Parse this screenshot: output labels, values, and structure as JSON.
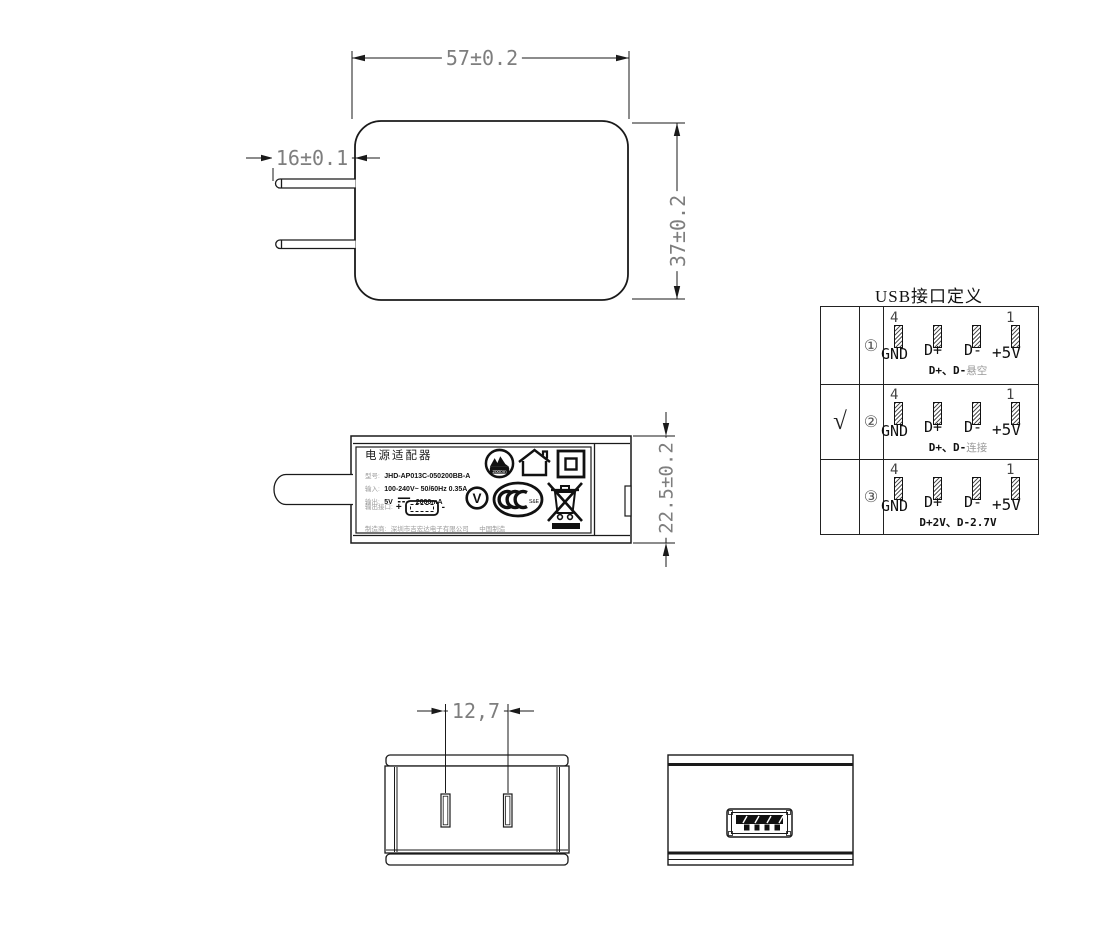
{
  "dimensions": {
    "front_width": "57±0.2",
    "prong_length": "16±0.1",
    "front_height": "37±0.2",
    "side_thickness": "22.5±0.2",
    "prong_pitch": "12,7"
  },
  "label": {
    "title": "电源适配器",
    "model_key": "型号:",
    "model_value": "JHD-AP013C-050200BB-A",
    "input_key": "输入:",
    "input_value": "100-240V~  50/60Hz  0.35A",
    "output_key": "输出:",
    "output_voltage": "5V",
    "output_current": "2000mA",
    "port_key": "输出接口:",
    "port_plus": "+",
    "port_minus": "-",
    "maker_key": "制造商:",
    "maker_value": "深圳市吉宏达电子有限公司",
    "origin": "中国制造",
    "altitude_mark": "2000m",
    "efficiency_mark": "V",
    "ccc_suffix": "S&E"
  },
  "usb_table": {
    "title": "USB接口定义",
    "rows": [
      {
        "mark": "",
        "index": "①",
        "pin_num_left": "4",
        "pin_num_right": "1",
        "pins": [
          "GND",
          "D+",
          "D-",
          "+5V"
        ],
        "note_bold": "D+、D-",
        "note_gray": "悬空"
      },
      {
        "mark": "√",
        "index": "②",
        "pin_num_left": "4",
        "pin_num_right": "1",
        "pins": [
          "GND",
          "D+",
          "D-",
          "+5V"
        ],
        "note_bold": "D+、D-",
        "note_gray": "连接"
      },
      {
        "mark": "",
        "index": "③",
        "pin_num_left": "4",
        "pin_num_right": "1",
        "pins": [
          "GND",
          "D+",
          "D-",
          "+5V"
        ],
        "note_bold": "D+2V、D-2.7V",
        "note_gray": ""
      }
    ]
  }
}
